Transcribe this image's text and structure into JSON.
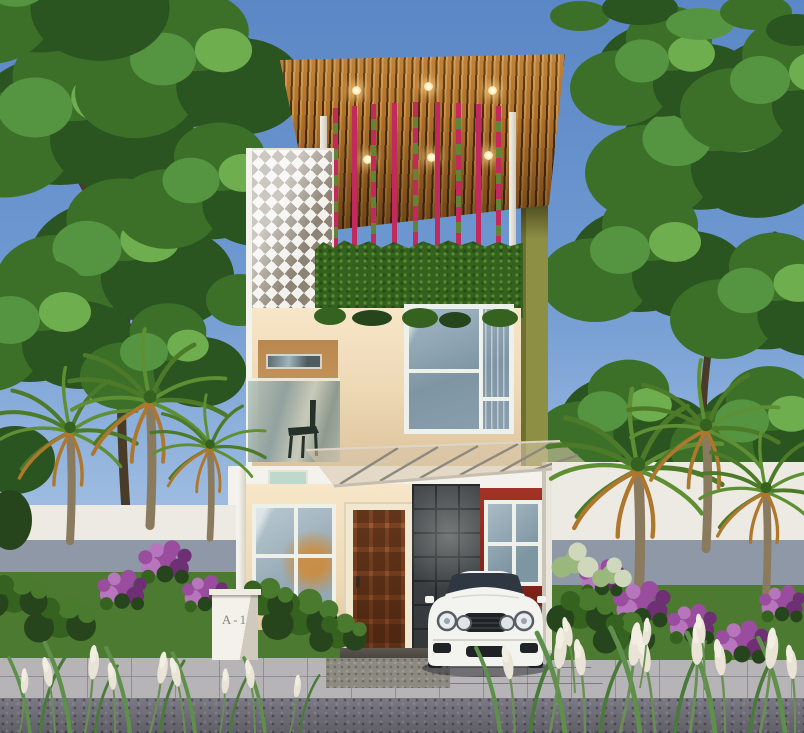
{
  "scene": {
    "house_number": "A-1"
  },
  "palette": {
    "sky_top": "#5b87c6",
    "sky_mid": "#6f99d1",
    "sky_low": "#93b4de",
    "sky_horizon": "#b9cfe8",
    "tree_dark": "#2a5420",
    "tree_mid": "#3c7029",
    "tree_light": "#559441",
    "tree_lighter": "#6fae4f",
    "trunk": "#4a3a28",
    "roof_wood": "#b5752c",
    "roof_wood_light": "#d49549",
    "roof_gap": "#462d0e",
    "light_warm": "#ffdf9e",
    "frame_white": "#f4f2ec",
    "rod_pink": "#c22a5e",
    "hedge_base": "#35611f",
    "hedge_hi": "#548c2e",
    "hedge_lo": "#254d15",
    "breeze_light": "#f2f1ed",
    "breeze_dark": "#8d8375",
    "olive": "#8d8f45",
    "olive_dark": "#6e7030",
    "wall_cream": "#eed9b6",
    "wall_cream_hi": "#f7e6c8",
    "wall_shadow": "#d9bf97",
    "balcony_tan": "#c9995f",
    "window_frame": "#eef0ea",
    "glass_main": "#a3b8c6",
    "glass_deep": "#7e95a4",
    "awning_glass": "#d8c7ab",
    "awning_strut": "#8d887e",
    "mint": "#bfd8cc",
    "door_frame": "#f2e8d0",
    "door_wood": "#a05a32",
    "door_wood_dark": "#743c1b",
    "stone": "#45484a",
    "stone_line": "#24272a",
    "red_wall": "#a23325",
    "red_dark": "#741f16",
    "carport_wall": "#eae6dc",
    "fence_white": "#eceae3",
    "fence_shade": "#8f98a6",
    "lawn": "#4d7a31",
    "walk_light": "#b6b4b6",
    "walk_joint": "#908e92",
    "walk_hi": "#cecccf",
    "apron": "#a3a0a5",
    "road": "#7b7984",
    "road_dark": "#605e66",
    "mat": "#8d8a82",
    "car_white": "#f3f3f0",
    "car_glass": "#2e3742",
    "car_grille": "#1f2326",
    "chair": "#24322a",
    "palm_green": "#4c7a28",
    "palm_green2": "#5e8f33",
    "palm_dry": "#ad782e",
    "palm_trunk": "#8a7a5e",
    "bush_dark": "#27451d",
    "bush_mid": "#35621f",
    "bush_light": "#4a7a2e",
    "hydrangea": "#9ab87e",
    "hydrangea_light": "#cfd8bd",
    "flower_purple": "#9a4d9e",
    "flower_light": "#b775bd",
    "flower_deep": "#6e2f74",
    "grass_blade": "#5e8f4b",
    "grass_blade2": "#4a7a3a",
    "grass_stem": "#6a8f55",
    "plume": "#e9e4d6",
    "plume_bright": "#f2eee2",
    "pillar_face": "#f4f1ea",
    "pillar_side": "#cfcabd",
    "pillar_text": "#8a8577"
  }
}
